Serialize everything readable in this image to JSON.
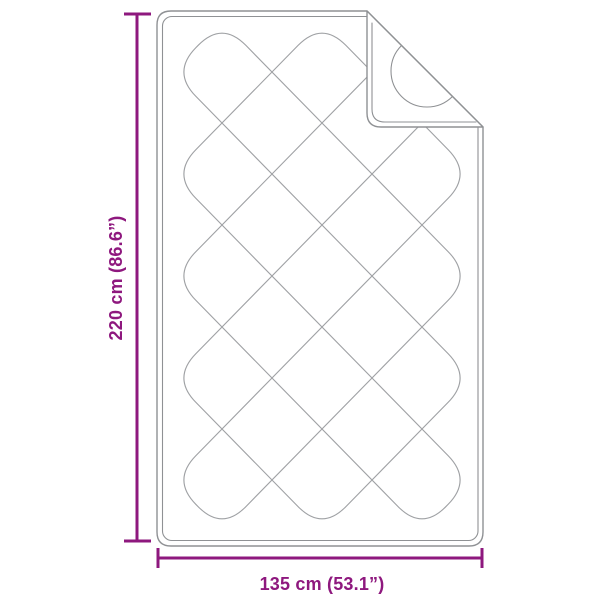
{
  "diagram": {
    "product": "quilted blanket with folded corner",
    "height_label": "220 cm (86.6”)",
    "width_label": "135 cm (53.1”)",
    "colors": {
      "dimension": "#8E187E",
      "outline": "#8F9194",
      "pattern": "#9FA1A4",
      "background": "#FFFFFF"
    }
  }
}
